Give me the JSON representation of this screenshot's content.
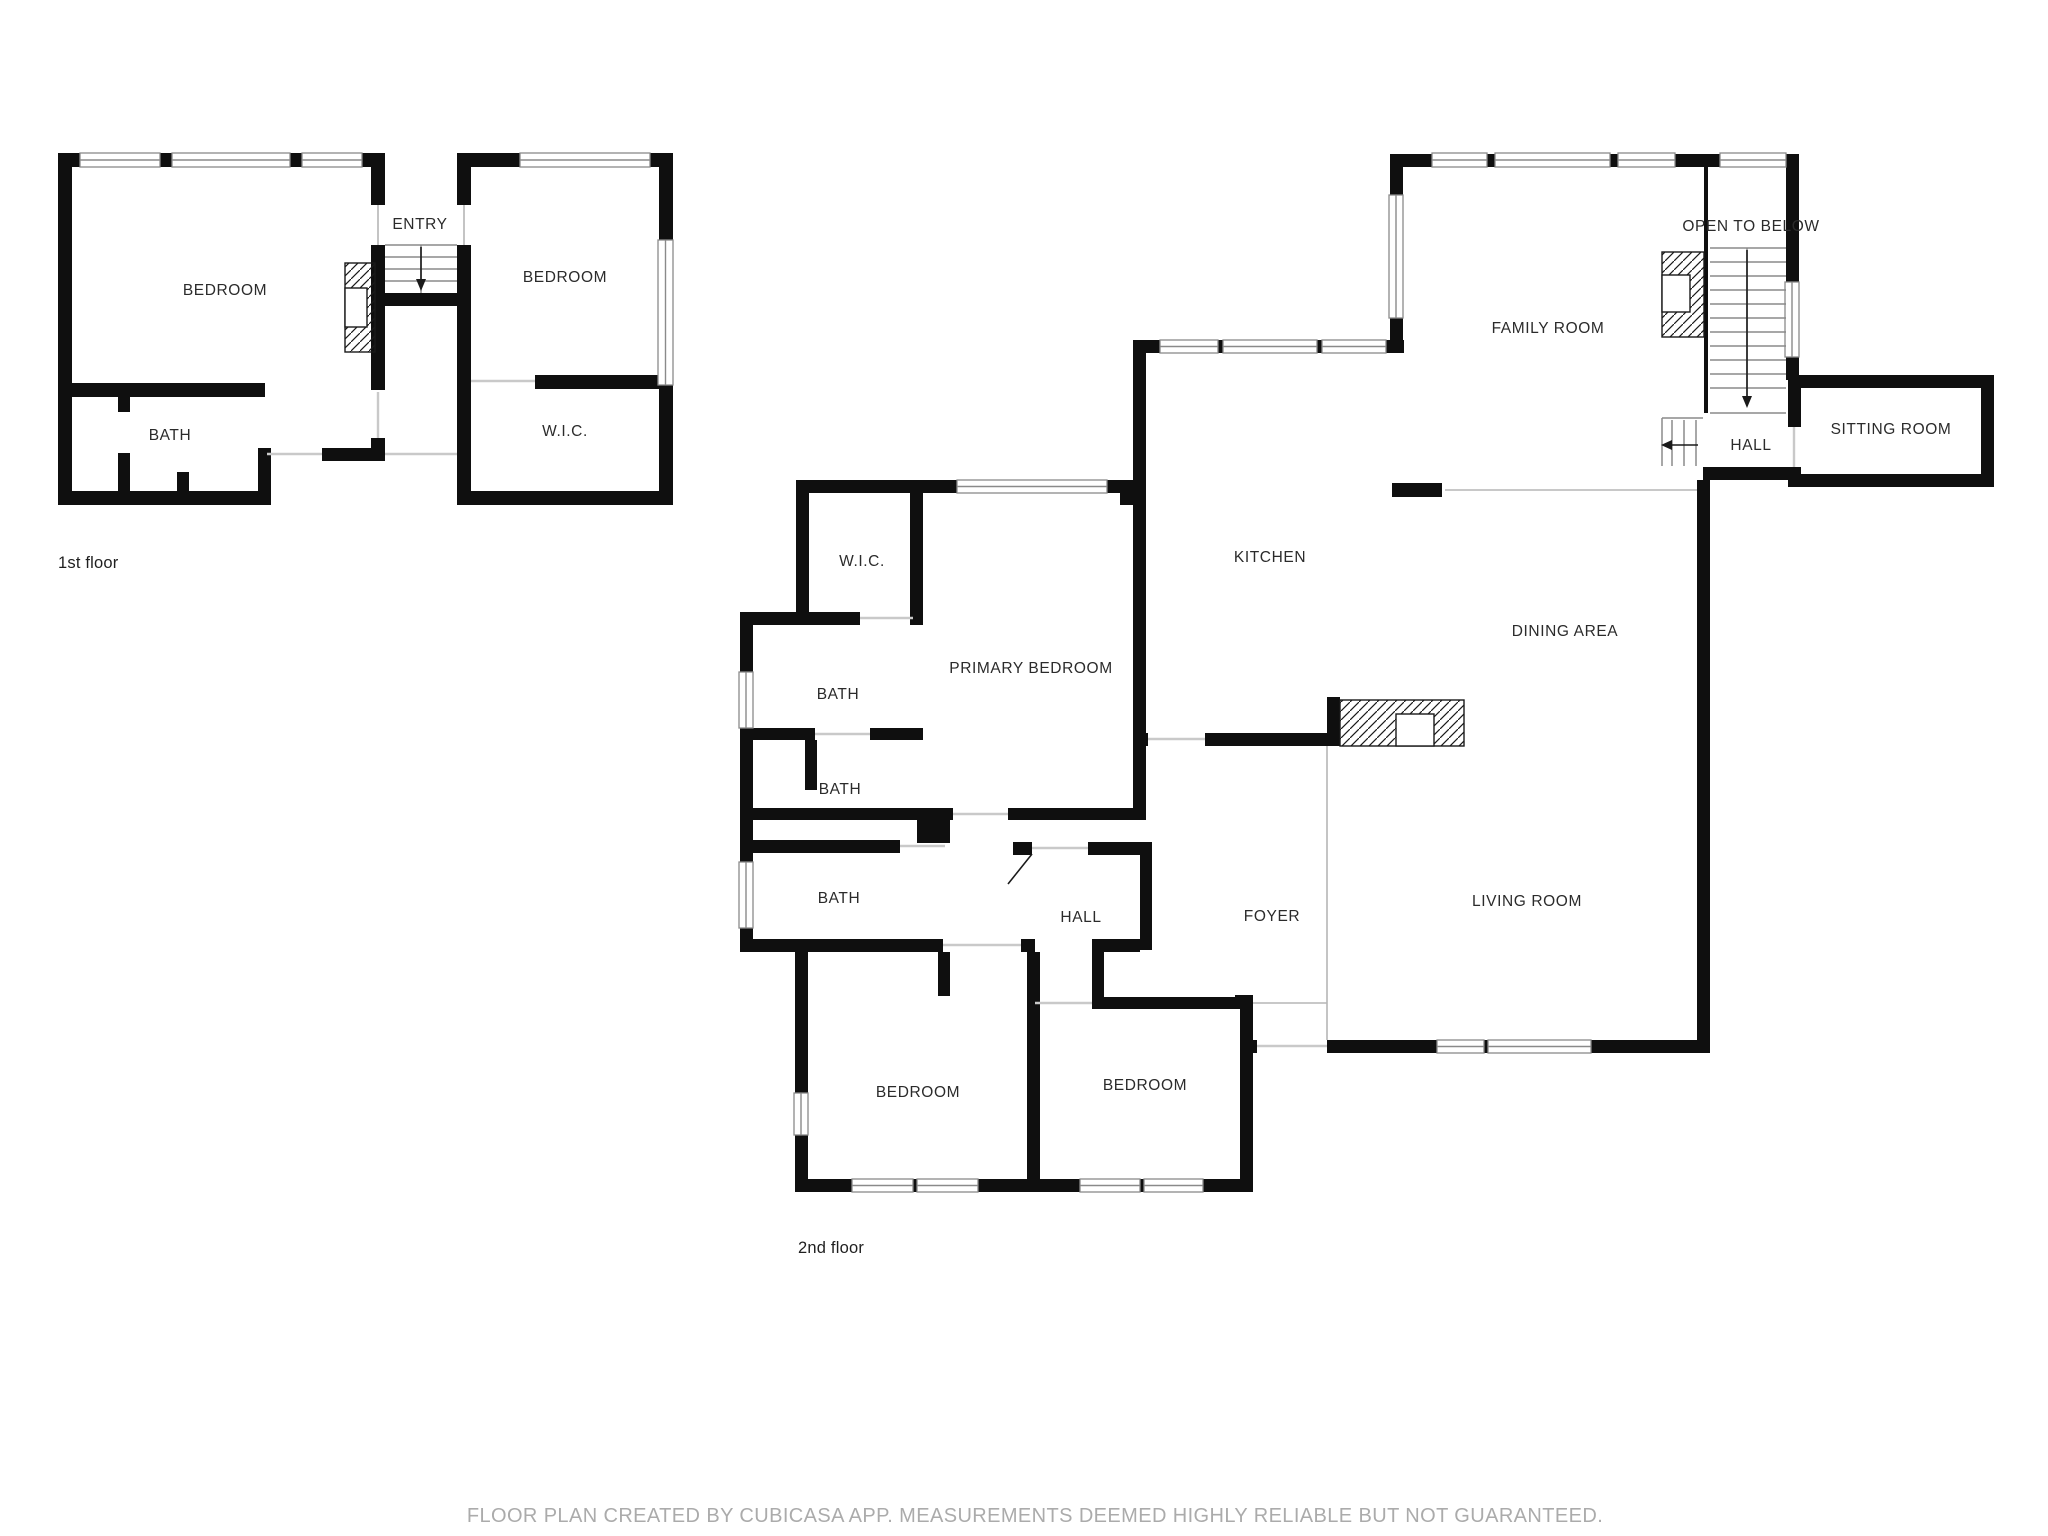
{
  "floors": [
    {
      "label": "1st floor",
      "rooms": [
        {
          "label": "BEDROOM"
        },
        {
          "label": "ENTRY"
        },
        {
          "label": "BEDROOM"
        },
        {
          "label": "BATH"
        },
        {
          "label": "W.I.C."
        }
      ]
    },
    {
      "label": "2nd floor",
      "rooms": [
        {
          "label": "FAMILY ROOM"
        },
        {
          "label": "OPEN TO BELOW"
        },
        {
          "label": "SITTING ROOM"
        },
        {
          "label": "HALL"
        },
        {
          "label": "KITCHEN"
        },
        {
          "label": "DINING AREA"
        },
        {
          "label": "W.I.C."
        },
        {
          "label": "PRIMARY BEDROOM"
        },
        {
          "label": "BATH"
        },
        {
          "label": "BATH"
        },
        {
          "label": "BATH"
        },
        {
          "label": "HALL"
        },
        {
          "label": "FOYER"
        },
        {
          "label": "LIVING ROOM"
        },
        {
          "label": "BEDROOM"
        },
        {
          "label": "BEDROOM"
        }
      ]
    }
  ],
  "footer": "FLOOR PLAN CREATED BY CUBICASA APP. MEASUREMENTS DEEMED HIGHLY RELIABLE BUT NOT GUARANTEED.",
  "colors": {
    "wall": "#0f0f0f",
    "window_frame": "#8a8a8a",
    "stair_line": "#8a8a8a",
    "door_opening": "#c9c9c9",
    "label_text": "#2b2b2b",
    "footer_text": "#ababab",
    "background": "#ffffff"
  }
}
